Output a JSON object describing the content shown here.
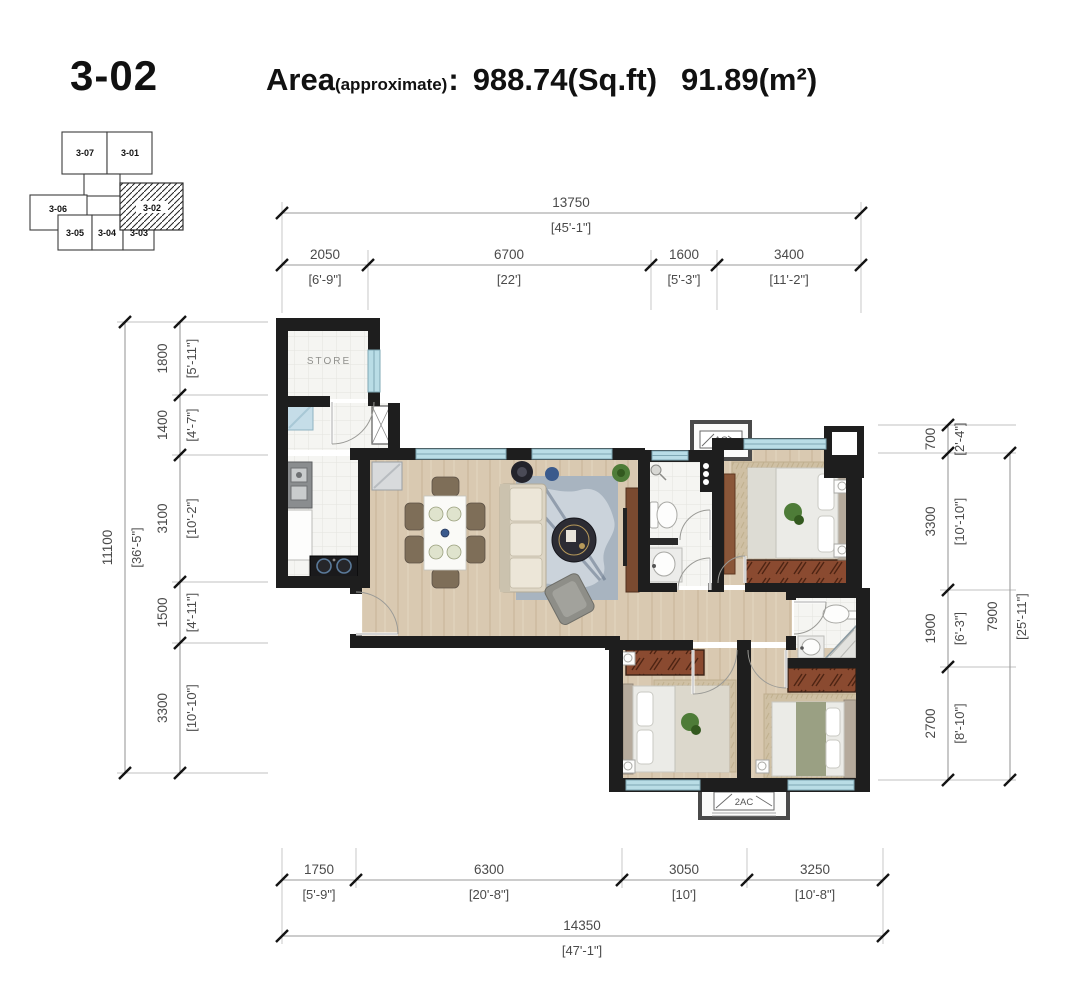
{
  "header": {
    "unit": "3-02",
    "area_label": "Area",
    "area_note": "(approximate)",
    "colon": ":",
    "area_sqft": "988.74(Sq.ft)",
    "area_sqm": "91.89(m²)"
  },
  "key_plan": {
    "highlighted_unit": "3-02",
    "units": [
      {
        "id": "3-07"
      },
      {
        "id": "3-01"
      },
      {
        "id": "3-06"
      },
      {
        "id": "3-05"
      },
      {
        "id": "3-04"
      },
      {
        "id": "3-03"
      },
      {
        "id": "3-02"
      }
    ]
  },
  "dimensions": {
    "top": {
      "total": {
        "mm": "13750",
        "imperial": "[45'-1\"]"
      },
      "segments": [
        {
          "mm": "2050",
          "imperial": "[6'-9\"]"
        },
        {
          "mm": "6700",
          "imperial": "[22']"
        },
        {
          "mm": "1600",
          "imperial": "[5'-3\"]"
        },
        {
          "mm": "3400",
          "imperial": "[11'-2\"]"
        }
      ]
    },
    "bottom": {
      "total": {
        "mm": "14350",
        "imperial": "[47'-1\"]"
      },
      "segments": [
        {
          "mm": "1750",
          "imperial": "[5'-9\"]"
        },
        {
          "mm": "6300",
          "imperial": "[20'-8\"]"
        },
        {
          "mm": "3050",
          "imperial": "[10']"
        },
        {
          "mm": "3250",
          "imperial": "[10'-8\"]"
        }
      ]
    },
    "left": {
      "total": {
        "mm": "11100",
        "imperial": "[36'-5\"]"
      },
      "segments": [
        {
          "mm": "1800",
          "imperial": "[5'-11\"]"
        },
        {
          "mm": "1400",
          "imperial": "[4'-7\"]"
        },
        {
          "mm": "3100",
          "imperial": "[10'-2\"]"
        },
        {
          "mm": "1500",
          "imperial": "[4'-11\"]"
        },
        {
          "mm": "3300",
          "imperial": "[10'-10\"]"
        }
      ]
    },
    "right": {
      "total": {
        "mm": "7900",
        "imperial": "[25'-11\"]"
      },
      "segments": [
        {
          "mm": "700",
          "imperial": "[2'-4\"]"
        },
        {
          "mm": "3300",
          "imperial": "[10'-10\"]"
        },
        {
          "mm": "1900",
          "imperial": "[6'-3\"]"
        },
        {
          "mm": "2700",
          "imperial": "[8'-10\"]"
        }
      ]
    }
  },
  "plan": {
    "labels": {
      "store": "STORE",
      "ac": "AC",
      "ac2": "2AC"
    }
  },
  "colors": {
    "wall": "#1e1e1e",
    "wood_floor": "#d9c9b1",
    "tile_floor": "#f5f5f2",
    "window": "#b9dde6",
    "wardrobe": "#8a4a30",
    "dimension_text": "#4a4a4a"
  }
}
